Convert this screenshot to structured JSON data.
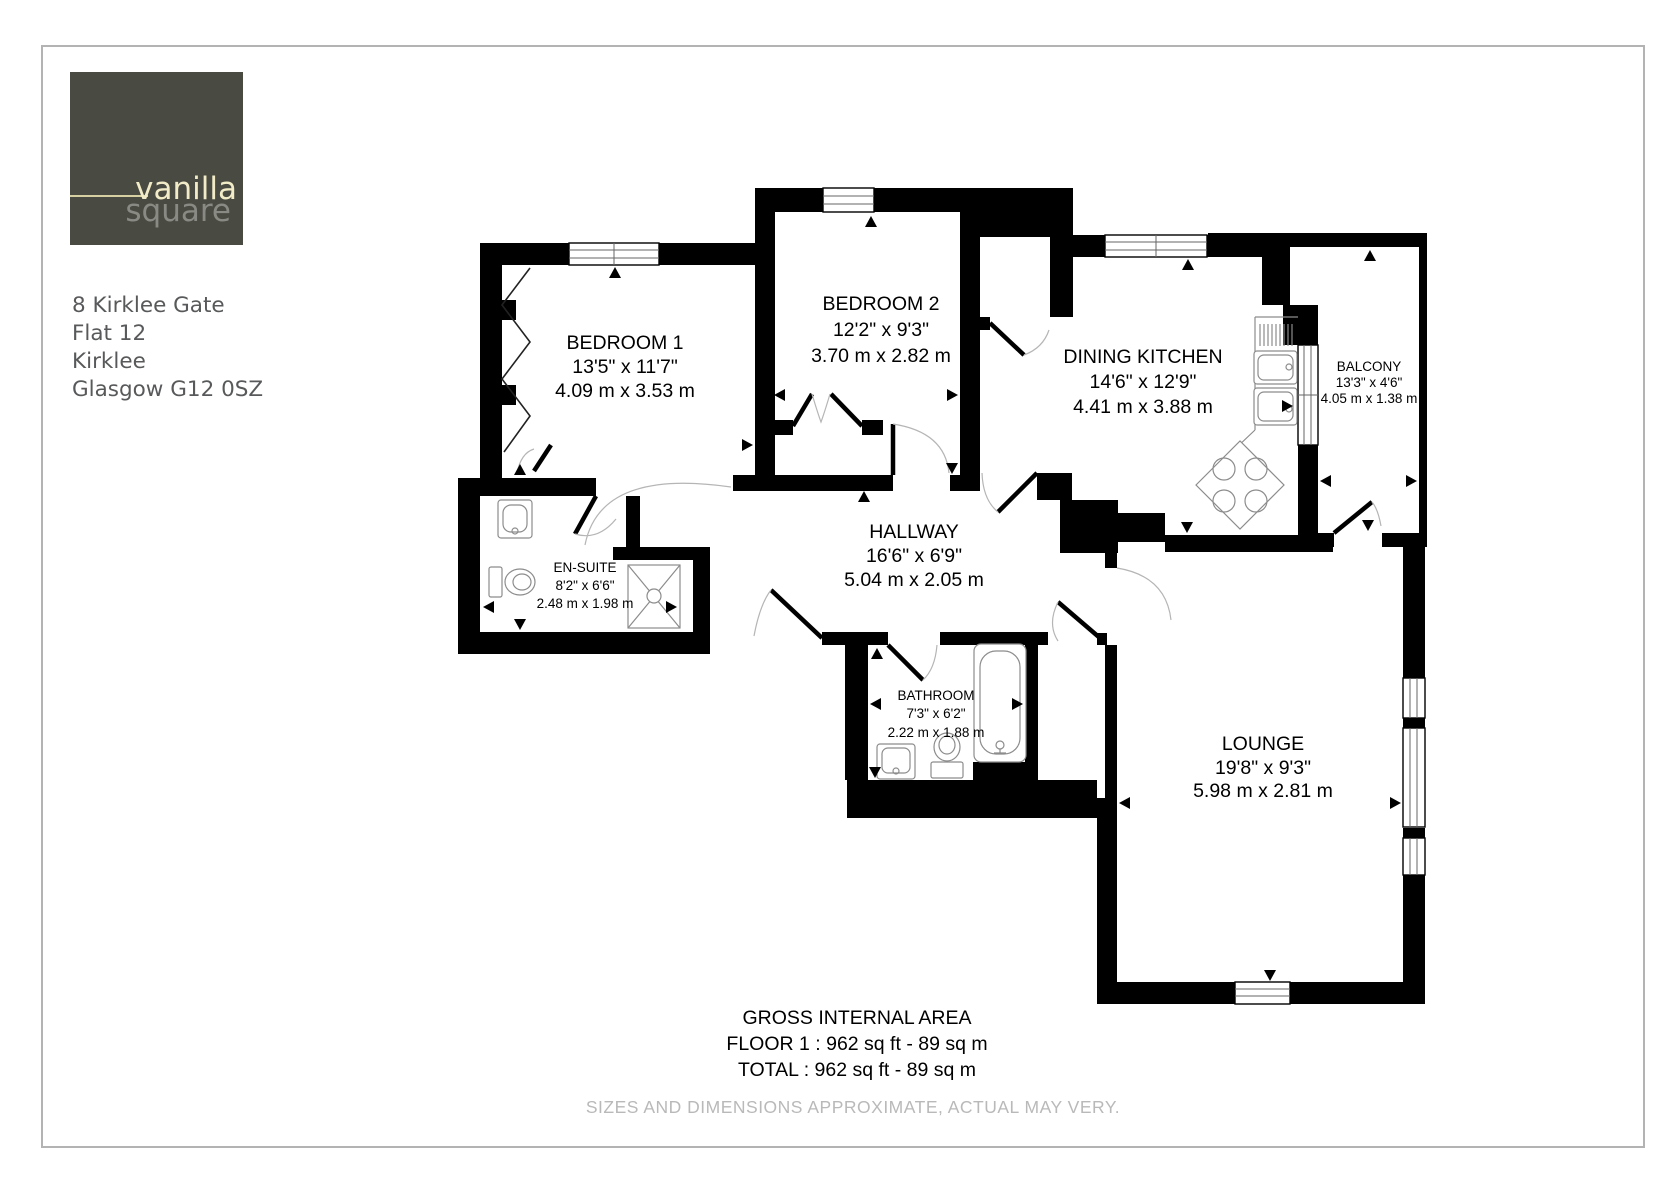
{
  "page": {
    "background": "#ffffff",
    "border_color": "#b3b3b3",
    "wall_color": "#000000"
  },
  "logo": {
    "text_primary": "vanilla",
    "text_secondary": "square",
    "bg_color": "#494a42",
    "primary_color": "#f1ebc7",
    "secondary_color": "#8f9089",
    "rule_color": "#d6d0a2"
  },
  "address": {
    "line1": "8 Kirklee Gate",
    "line2": "Flat 12",
    "line3": "Kirklee",
    "line4": "Glasgow G12 0SZ"
  },
  "rooms": {
    "bedroom1": {
      "name": "BEDROOM 1",
      "imperial": "13'5\" x 11'7\"",
      "metric": "4.09 m x 3.53 m"
    },
    "bedroom2": {
      "name": "BEDROOM 2",
      "imperial": "12'2\" x 9'3\"",
      "metric": "3.70 m x 2.82 m"
    },
    "dining_kitchen": {
      "name": "DINING KITCHEN",
      "imperial": "14'6\" x 12'9\"",
      "metric": "4.41 m x 3.88 m"
    },
    "balcony": {
      "name": "BALCONY",
      "imperial": "13'3\" x 4'6\"",
      "metric": "4.05 m x 1.38 m"
    },
    "en_suite": {
      "name": "EN-SUITE",
      "imperial": "8'2\" x 6'6\"",
      "metric": "2.48 m x 1.98 m"
    },
    "hallway": {
      "name": "HALLWAY",
      "imperial": "16'6\" x 6'9\"",
      "metric": "5.04 m x 2.05 m"
    },
    "bathroom": {
      "name": "BATHROOM",
      "imperial": "7'3\" x 6'2\"",
      "metric": "2.22 m x 1.88 m"
    },
    "lounge": {
      "name": "LOUNGE",
      "imperial": "19'8\" x 9'3\"",
      "metric": "5.98 m x 2.81 m"
    }
  },
  "summary": {
    "title": "GROSS INTERNAL AREA",
    "floor_line": "FLOOR 1 : 962 sq ft - 89 sq m",
    "total_line": "TOTAL : 962 sq ft - 89 sq m"
  },
  "disclaimer": "SIZES AND DIMENSIONS APPROXIMATE, ACTUAL MAY VERY."
}
